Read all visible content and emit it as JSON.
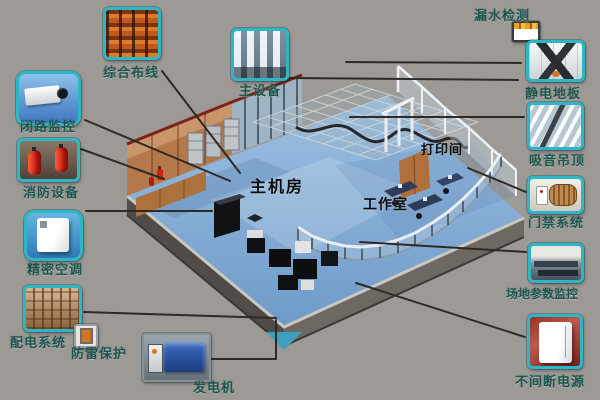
{
  "diagram": {
    "background_color": "#9d9a96",
    "accent_color": "#2cb6c6",
    "label_color": "#1e564f",
    "connector_color": "#2e2a25",
    "room_labels": {
      "main_room": "主机房",
      "workspace": "工作室",
      "print_room": "打印间"
    },
    "callouts": [
      {
        "id": "cabling",
        "label": "综合布线"
      },
      {
        "id": "cctv",
        "label": "闭路监控"
      },
      {
        "id": "fire",
        "label": "消防设备"
      },
      {
        "id": "ac",
        "label": "精密空调"
      },
      {
        "id": "power",
        "label": "配电系统"
      },
      {
        "id": "lightning",
        "label": "防雷保护"
      },
      {
        "id": "generator",
        "label": "发电机"
      },
      {
        "id": "main_equipment",
        "label": "主设备"
      },
      {
        "id": "leak",
        "label": "漏水检测"
      },
      {
        "id": "floor",
        "label": "静电地板"
      },
      {
        "id": "ceiling",
        "label": "吸音吊顶"
      },
      {
        "id": "access",
        "label": "门禁系统"
      },
      {
        "id": "site_monitor",
        "label": "场地参数监控"
      },
      {
        "id": "ups",
        "label": "不间断电源"
      }
    ]
  }
}
